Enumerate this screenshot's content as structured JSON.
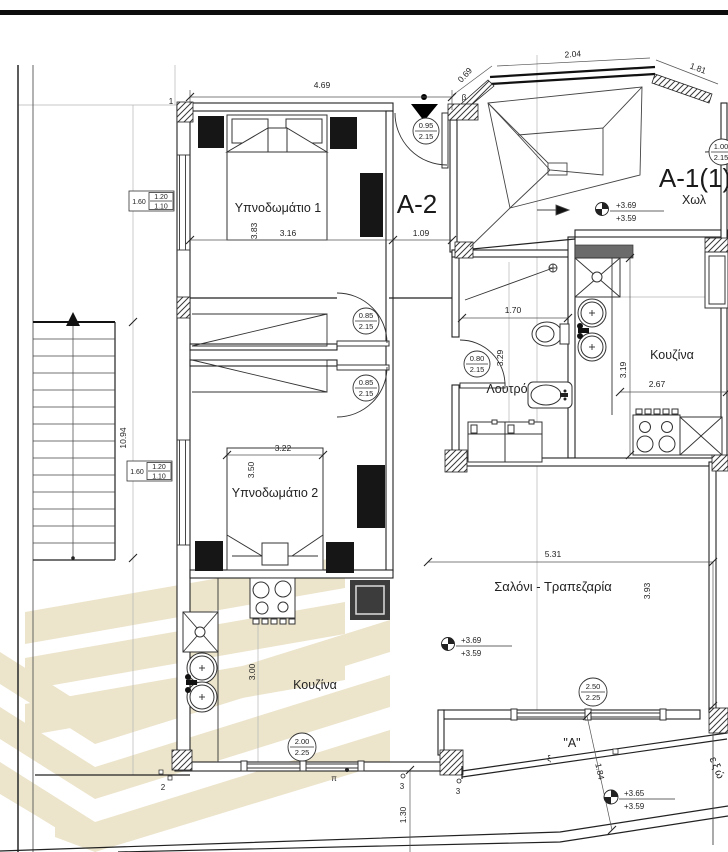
{
  "labels": {
    "unit_a2": "A-2",
    "unit_a1": "A-1(1)",
    "hall": "Χωλ",
    "bedroom1": "Υπνοδωμάτιο 1",
    "bedroom2": "Υπνοδωμάτιο 2",
    "bathroom": "Λουτρό",
    "kitchen_a1": "Κουζίνα",
    "kitchen_a2": "Κουζίνα",
    "living": "Σαλόνι - Τραπεζαρία",
    "balcony": "\"A\"",
    "balcony_edge": "εξώ",
    "rail_xi": "ξ",
    "pi_mark": "π"
  },
  "dims": {
    "top_w": "4.69",
    "top_diag": "0.69",
    "top_r1": "2.04",
    "top_r2": "1.81",
    "bed1_h": "3.83",
    "bed1_w": "3.16",
    "entry_w": "1.09",
    "bath_w": "1.70",
    "bath_h": "3.29",
    "kit1_h": "3.19",
    "kit1_w": "2.67",
    "bed2_w": "3.22",
    "bed2_h": "3.50",
    "living_w": "5.31",
    "living_h": "3.93",
    "kit2_h": "3.00",
    "stair_l": "10.94",
    "balc_d": "1.84",
    "bottom_h": "1.30"
  },
  "tags": {
    "entry_a2": {
      "w": "0.95",
      "h": "2.15"
    },
    "entry_a1": {
      "w": "1.00",
      "h": "2.15"
    },
    "bed1_door": {
      "w": "0.85",
      "h": "2.15"
    },
    "bed2_door": {
      "w": "0.85",
      "h": "2.15"
    },
    "bath_door": {
      "w": "0.80",
      "h": "2.15"
    },
    "living_window": {
      "w": "2.50",
      "h": "2.25"
    },
    "kitchen_window": {
      "w": "2.00",
      "h": "2.25"
    }
  },
  "windows": {
    "bed1": {
      "sill": "1.60",
      "w": "1.20",
      "h": "1.10"
    },
    "bed2": {
      "sill": "1.60",
      "w": "1.20",
      "h": "1.10"
    }
  },
  "levels": {
    "hall": {
      "a": "+3.69",
      "b": "+3.59"
    },
    "living": {
      "a": "+3.69",
      "b": "+3.59"
    },
    "balcony": {
      "a": "+3.65",
      "b": "+3.59"
    }
  },
  "grid": {
    "n1": "1",
    "n2": "2",
    "n3": "3",
    "beta": "β"
  },
  "colors": {
    "watermark": "#ece4cb",
    "furniture": "#161616"
  }
}
